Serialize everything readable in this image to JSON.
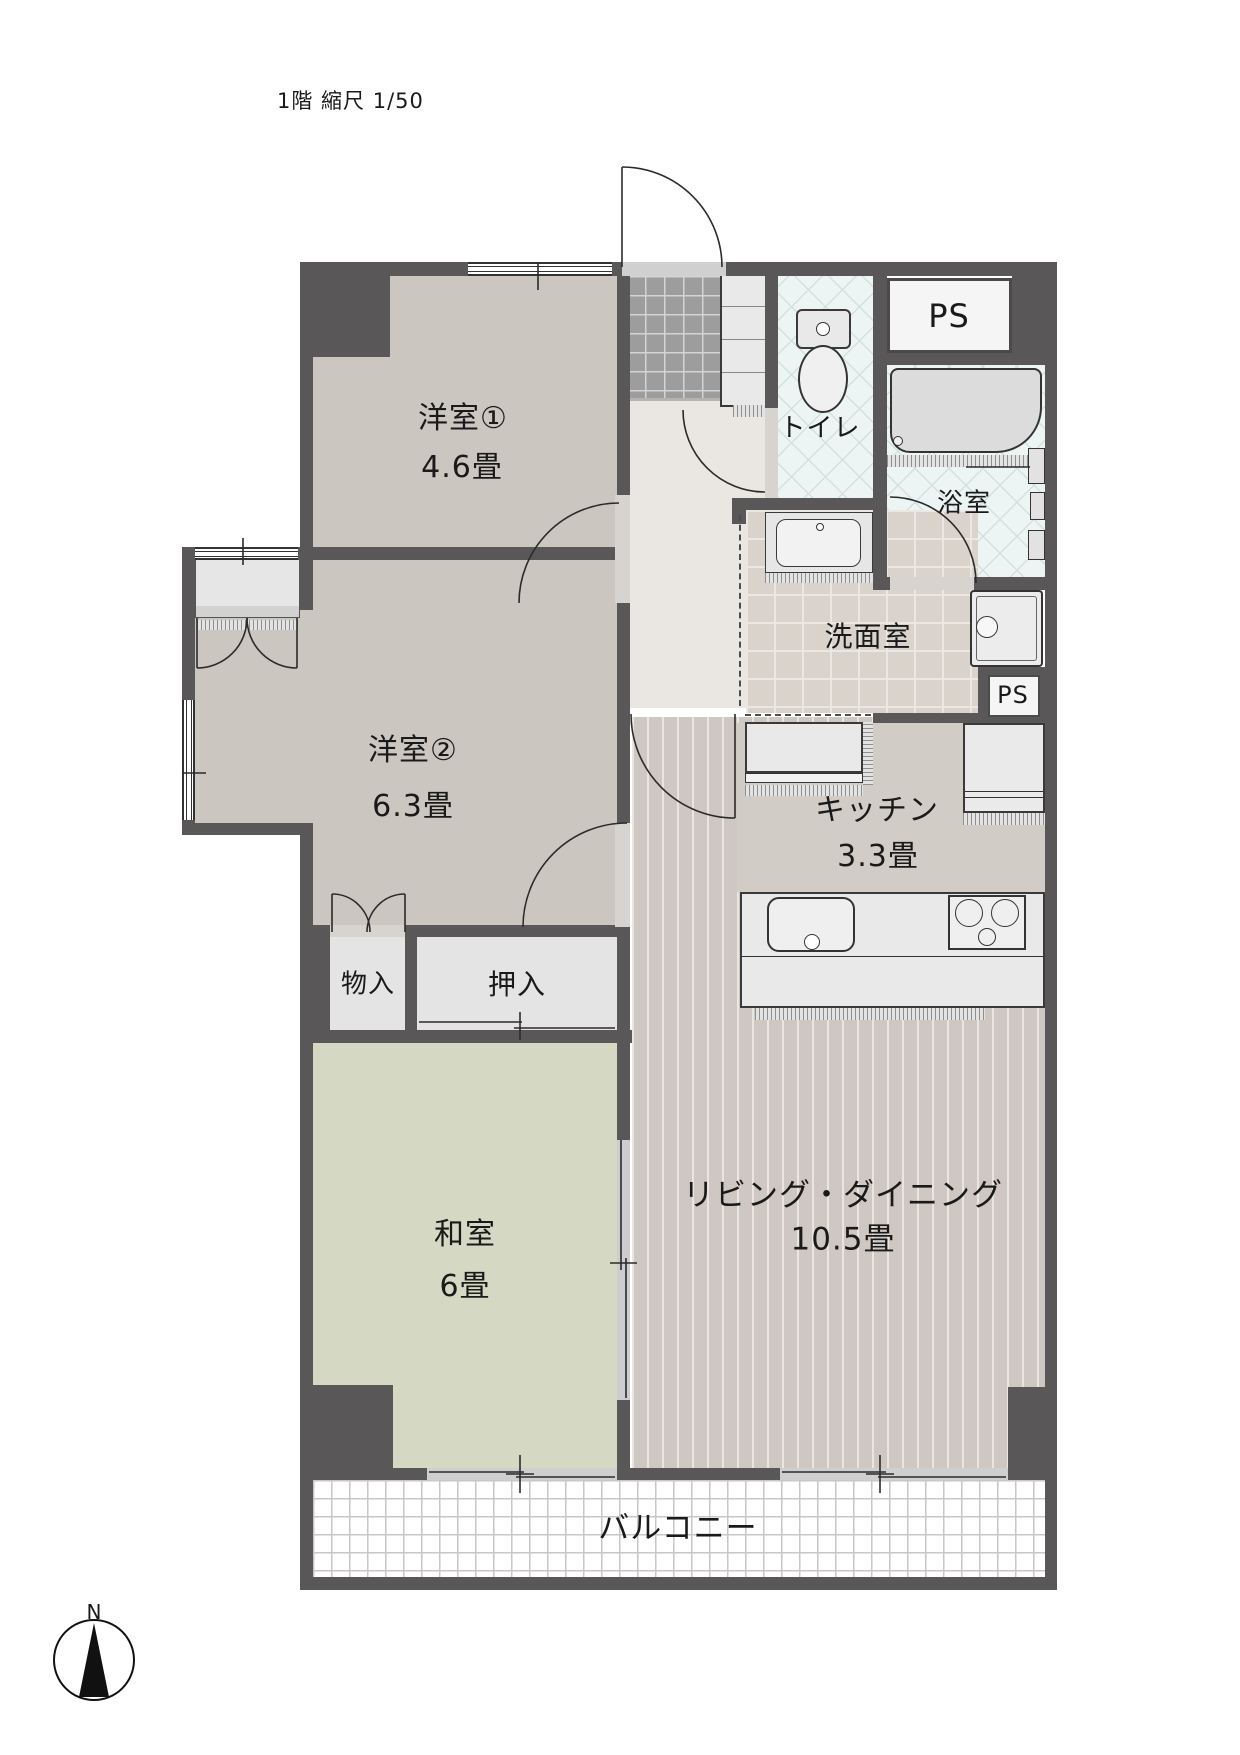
{
  "title": "1階 縮尺 1/50",
  "compass": {
    "north": "N"
  },
  "colors": {
    "wall": "#595757",
    "tatami": "#d5d9c3",
    "wet_tile": "#edf5f4",
    "wood_floor": "#cfc8c2",
    "genkan_tile": "#9d9d9d"
  },
  "rooms": {
    "western1": {
      "name": "洋室①",
      "size": "4.6畳"
    },
    "western2": {
      "name": "洋室②",
      "size": "6.3畳"
    },
    "japanese": {
      "name": "和室",
      "size": "6畳"
    },
    "living": {
      "name": "リビング・ダイニング",
      "size": "10.5畳"
    },
    "kitchen": {
      "name": "キッチン",
      "size": "3.3畳"
    },
    "toilet": {
      "name": "トイレ"
    },
    "bath": {
      "name": "浴室"
    },
    "washroom": {
      "name": "洗面室"
    },
    "storage": {
      "name": "物入"
    },
    "closet": {
      "name": "押入"
    },
    "balcony": {
      "name": "バルコニー"
    },
    "ps_upper": {
      "name": "PS"
    },
    "ps_lower": {
      "name": "PS"
    }
  }
}
